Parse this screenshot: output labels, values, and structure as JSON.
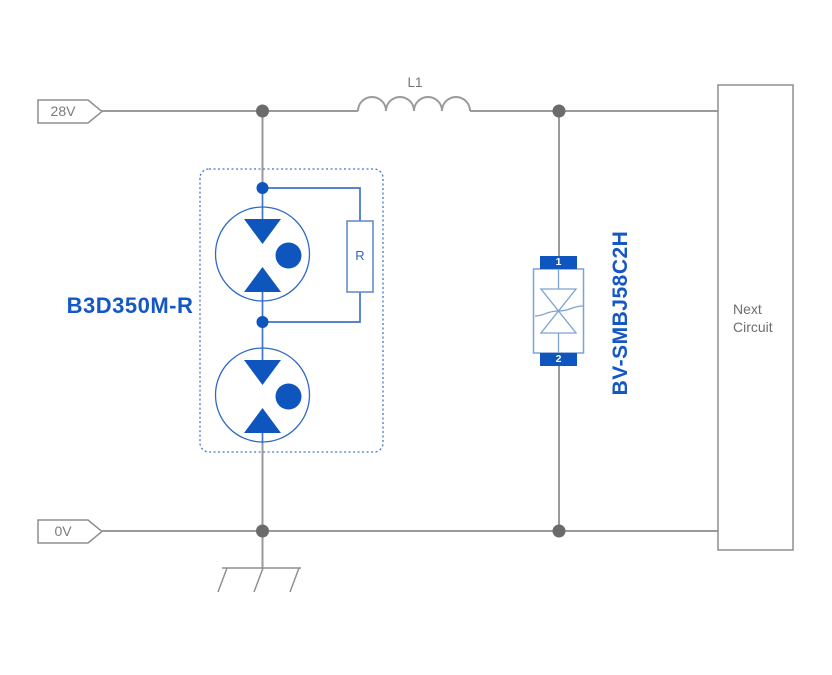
{
  "diagram": {
    "power_rail_label": "28V",
    "ground_rail_label": "0V",
    "inductor_label": "L1",
    "gdt_label": "B3D350M-R",
    "resistor_label": "R",
    "tvs_label": "BV-SMBJ58C2H",
    "tvs_pin1": "1",
    "tvs_pin2": "2",
    "next_circuit_label": "Next Circuit"
  },
  "colors": {
    "wire_gray": "#9a9a9a",
    "junction_gray": "#6b6b6b",
    "component_blue": "#0e55bd",
    "component_wire_blue": "#3f74c8",
    "light_outline_blue": "#7da3d4",
    "label_blue": "#1457c5",
    "text_gray": "#757575"
  }
}
